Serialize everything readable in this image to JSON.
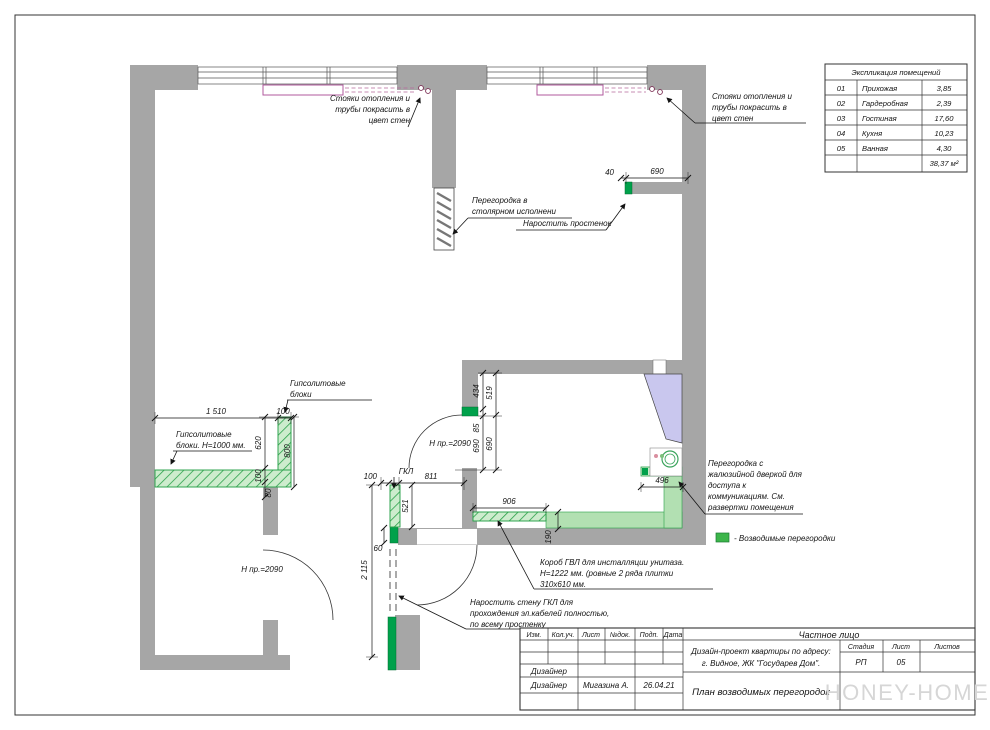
{
  "drawing": {
    "explication": {
      "title": "Экспликация помещений",
      "rows": [
        {
          "num": "01",
          "name": "Прихожая",
          "area": "3,85"
        },
        {
          "num": "02",
          "name": "Гардеробная",
          "area": "2,39"
        },
        {
          "num": "03",
          "name": "Гостиная",
          "area": "17,60"
        },
        {
          "num": "04",
          "name": "Кухня",
          "area": "10,23"
        },
        {
          "num": "05",
          "name": "Ванная",
          "area": "4,30"
        }
      ],
      "total_area": "38,37 м²"
    },
    "title_block": {
      "cols": {
        "izm": "Изм.",
        "koluch": "Кол.уч.",
        "list": "Лист",
        "ndok": "№док.",
        "podp": "Подп.",
        "data": "Дата"
      },
      "client": "Частное лицо",
      "project_line1": "Дизайн-проект квартиры по адресу:",
      "project_line2": "г. Видное, ЖК \"Государев Дом\".",
      "stage_label": "Стадия",
      "sheet_label": "Лист",
      "sheets_label": "Листов",
      "stage": "РП",
      "sheet": "05",
      "designer_role1": "Дизайнер",
      "designer_role2": "Дизайнер",
      "designer_name": "Мигазина А.",
      "date": "26.04.21",
      "drawing_title": "План возводимых перегородок",
      "watermark": "HONEY-HOME"
    },
    "legend": {
      "label": "- Возводимые перегородки",
      "color": "#3cb54a"
    },
    "annotations": {
      "risers_left": [
        "Стояки отопления и",
        "трубы покрасить в",
        "цвет стен"
      ],
      "risers_right": [
        "Стояки отопления и",
        "трубы покрасить в",
        "цвет стен"
      ],
      "joinery": [
        "Перегородка в",
        "столярном исполнени"
      ],
      "extend_pier": "Наростить простенок",
      "gyps_blocks": [
        "Гипсолитовые",
        "блоки"
      ],
      "gyps_blocks_h1000": [
        "Гипсолитовые",
        "блоки. Н=1000 мм."
      ],
      "louver_partition": [
        "Перегородка с",
        "жалюзийной дверкой для",
        "доступа к",
        "коммуникациям. См.",
        "развертки помещения"
      ],
      "gvl_box": [
        "Короб ГВЛ для инсталляции унитаза.",
        "Н=1222 мм. (ровные 2 ряда плитки",
        "310х610 мм."
      ],
      "gkl_wall": [
        "Наростить стену ГКЛ для",
        "прохождения эл.кабелей полностью,",
        "по всему простенку"
      ],
      "door_height_center": "Н пр.=2090",
      "door_height_left": "Н пр.=2090"
    },
    "dimensions": {
      "d1510": "1 510",
      "d100a": "100",
      "d620": "620",
      "d100b": "100",
      "d80": "80",
      "d800": "800",
      "d40": "40",
      "d690top": "690",
      "d434": "434",
      "d85": "85",
      "d690a": "690",
      "d519": "519",
      "d690b": "690",
      "d100c": "100",
      "gkl": "ГКЛ",
      "d811": "811",
      "d521": "521",
      "d906": "906",
      "d190": "190",
      "d496": "496",
      "d60": "60",
      "d2115": "2 115"
    }
  }
}
